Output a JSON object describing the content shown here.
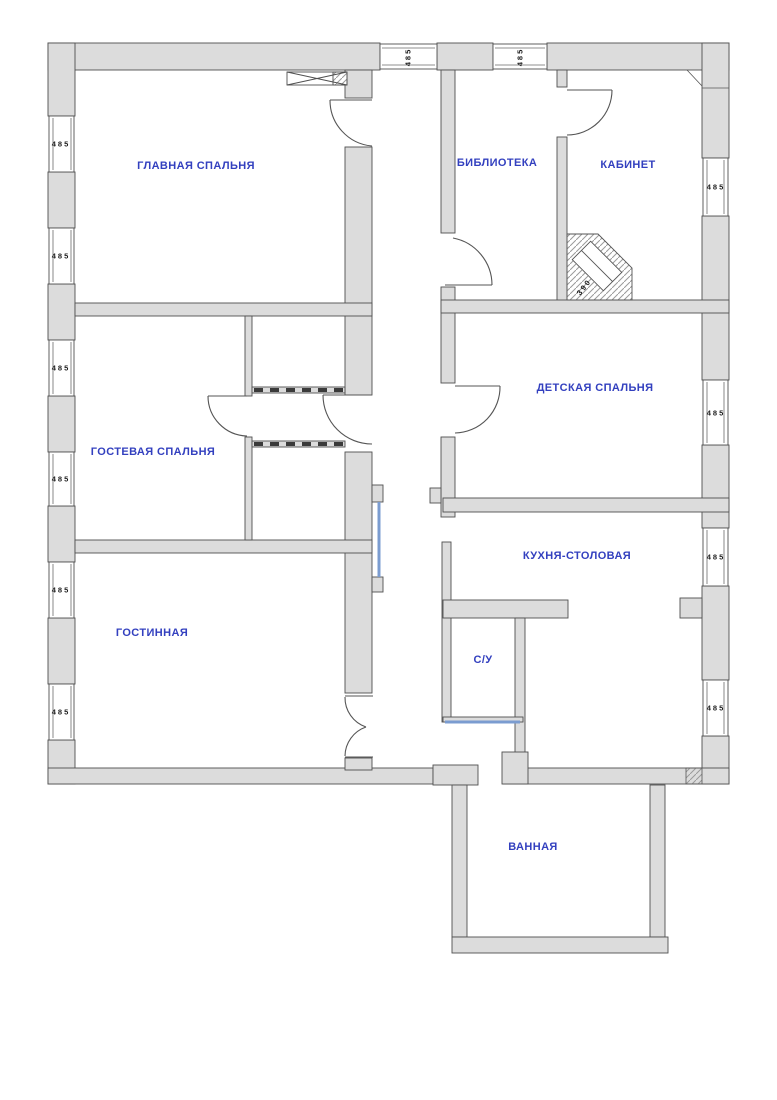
{
  "plan": {
    "name": "apartment-floor-plan",
    "width": 777,
    "height": 1100
  },
  "colors": {
    "background": "#ffffff",
    "wall_fill": "#dcdcdc",
    "wall_line": "#4f4f4f",
    "room_label": "#3340bf",
    "dim_text": "#1a1a1a",
    "glass_door": "#7b9cd0",
    "hatch_line": "#9a9a9a"
  },
  "rooms": [
    {
      "id": "main-bedroom",
      "label": "ГЛАВНАЯ СПАЛЬНЯ",
      "x": 196,
      "y": 166
    },
    {
      "id": "library",
      "label": "БИБЛИОТЕКА",
      "x": 497,
      "y": 163
    },
    {
      "id": "study",
      "label": "КАБИНЕТ",
      "x": 628,
      "y": 165
    },
    {
      "id": "guest-bedroom",
      "label": "ГОСТЕВАЯ СПАЛЬНЯ",
      "x": 153,
      "y": 452
    },
    {
      "id": "kids-bedroom",
      "label": "ДЕТСКАЯ СПАЛЬНЯ",
      "x": 595,
      "y": 388
    },
    {
      "id": "kitchen-dining",
      "label": "КУХНЯ-СТОЛОВАЯ",
      "x": 577,
      "y": 556
    },
    {
      "id": "wc",
      "label": "С/У",
      "x": 483,
      "y": 660
    },
    {
      "id": "living-room",
      "label": "ГОСТИННАЯ",
      "x": 152,
      "y": 633
    },
    {
      "id": "bathroom",
      "label": "ВАННАЯ",
      "x": 533,
      "y": 847
    }
  ],
  "dimensions": {
    "items": [
      {
        "id": "win-left-1",
        "value": "485",
        "x": 61,
        "y": 144,
        "rot": 0
      },
      {
        "id": "win-left-2",
        "value": "485",
        "x": 61,
        "y": 256,
        "rot": 0
      },
      {
        "id": "win-left-3",
        "value": "485",
        "x": 61,
        "y": 368,
        "rot": 0
      },
      {
        "id": "win-left-4",
        "value": "485",
        "x": 61,
        "y": 479,
        "rot": 0
      },
      {
        "id": "win-left-5",
        "value": "485",
        "x": 61,
        "y": 590,
        "rot": 0
      },
      {
        "id": "win-left-6",
        "value": "485",
        "x": 61,
        "y": 712,
        "rot": 0
      },
      {
        "id": "win-right-1",
        "value": "485",
        "x": 716,
        "y": 187,
        "rot": 0
      },
      {
        "id": "win-right-2",
        "value": "485",
        "x": 716,
        "y": 413,
        "rot": 0
      },
      {
        "id": "win-right-3",
        "value": "485",
        "x": 716,
        "y": 557,
        "rot": 0
      },
      {
        "id": "win-right-4",
        "value": "485",
        "x": 716,
        "y": 708,
        "rot": 0
      },
      {
        "id": "win-top-1",
        "value": "485",
        "x": 408,
        "y": 57,
        "rot": -90
      },
      {
        "id": "win-top-2",
        "value": "485",
        "x": 520,
        "y": 57,
        "rot": -90
      },
      {
        "id": "fireplace",
        "value": "390",
        "x": 584,
        "y": 287,
        "rot": -52
      }
    ]
  }
}
